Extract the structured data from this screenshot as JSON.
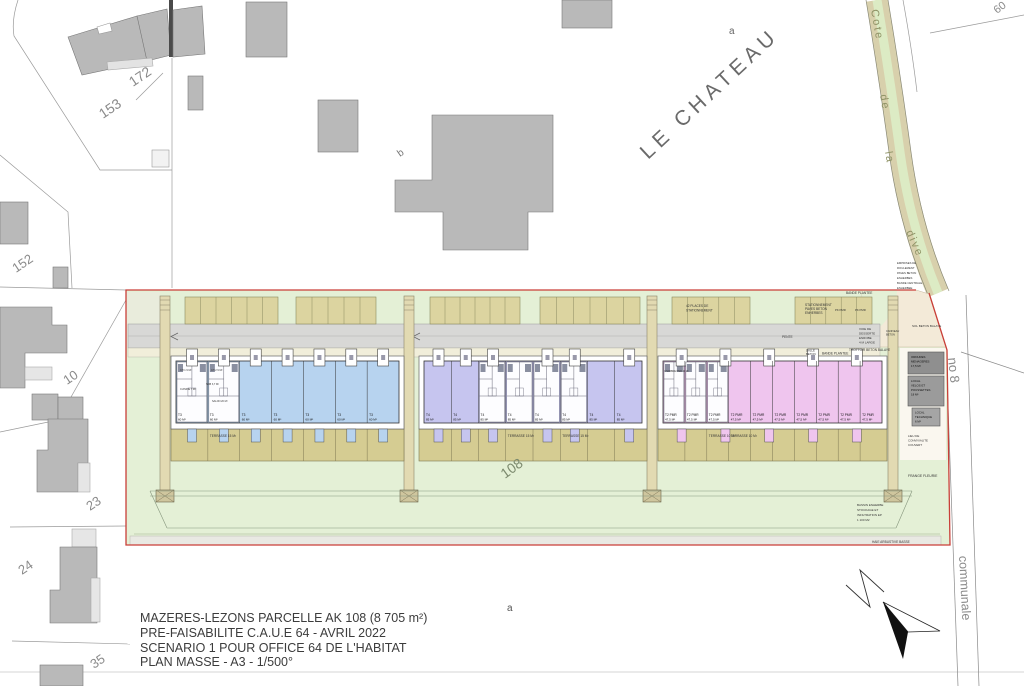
{
  "title_block": {
    "lines": [
      "MAZERES-LEZONS PARCELLE AK 108 (8 705 m²)",
      "PRE-FAISABILITE C.A.U.E 64 - AVRIL 2022",
      "SCENARIO 1 POUR OFFICE 64 DE L'HABITAT",
      "PLAN MASSE - A3 - 1/500°"
    ]
  },
  "parcel_labels": {
    "p153": "153",
    "p172": "172",
    "p152": "152",
    "p10": "10",
    "p23": "23",
    "p24": "24",
    "p35": "35",
    "p60": "60",
    "p108": "108",
    "sub_a_top": "a",
    "sub_a_bottom": "a",
    "sub_b": "b"
  },
  "streets": {
    "le_chateau": "LE  CHATEAU",
    "cote": "Cote",
    "de": "de",
    "la": "la",
    "dive": "dive",
    "no8": "no 8",
    "communale": "communale"
  },
  "annotations": {
    "bande_plantee_top": "BANDE PLANTEE",
    "bande_plantee_mid": "BANDE PLANTEE",
    "places_stationnement": [
      "42 PLACES DE",
      "STATIONNEMENT"
    ],
    "stationnement_paves": [
      "STATIONNEMENT",
      "PAVES BETON",
      "ENHERBES"
    ],
    "pk_pmr": "PK PMR",
    "voie_desserte": [
      "VOIE DE",
      "DESSERTE",
      "ENROBE",
      "4 M LARGE"
    ],
    "pente": "PENTE",
    "trottoir": "TROTTOIR BETON BALAYE",
    "dalle_beton": [
      "DALLE",
      "BETON"
    ],
    "emprises": [
      "EMPRISES DE",
      "ROULEMENT",
      "PAVES BETON",
      "ENHERBES",
      "BANDE CENTRALE",
      "ENHERBEE"
    ],
    "sol_beton": "SOL BETON BALAYE",
    "caniveau": [
      "CANIVEAU",
      "BETON"
    ],
    "frange_fleurie": "FRANGE FLEURIE",
    "bassin": [
      "BASSIN ENHERBE",
      "STOCKAGE ET",
      "INFILTRATION EP",
      "1 100 M2"
    ],
    "haie": "HAIE ARBUSTIVE BASSE"
  },
  "facilities": {
    "ordures": [
      "ORDURES",
      "MENAGERES",
      "17,5 M²"
    ],
    "velos": [
      "LOCAL",
      "VELOS ET",
      "POUSSETTES",
      "18 M²"
    ],
    "technique": [
      "LOCAL",
      "TECHNIQUE",
      "6 M²"
    ],
    "convivialite": [
      "LIEU DE",
      "CONVIVIALITE",
      "COUVERT"
    ]
  },
  "blocks": [
    {
      "type": "T3",
      "units": 7,
      "unit_label": "T3",
      "unit_area": "60 M²",
      "terrace_label": "TERRASSE 15 M²",
      "color": "#b7d3ef"
    },
    {
      "type": "T4",
      "units": 8,
      "unit_label": "T4",
      "unit_area": "85 M²",
      "terrace_label": "TERRASSE 15 M²",
      "color": "#c6c5ef"
    },
    {
      "type": "T2 PMR",
      "units": 10,
      "unit_label": "T2 PMR",
      "unit_area": "47,5 M²",
      "terrace_label": "TERRASSE 10 M²",
      "color": "#efc5ee"
    }
  ],
  "rooms": {
    "ch1": "CH 1 9 M²",
    "ch2": "CH 2 9 M²",
    "cuisine": "CUISINE 7 M²",
    "salon": "SALON 20 M²",
    "sdb": "SDB 3,7 M²",
    "chambre_pmr": "CHAMBRE PMR 11 M²"
  },
  "colors": {
    "site_green": "#e4f0d6",
    "boundary_red": "#c93f38",
    "parking_tan": "#dcd4a0",
    "terrace_khaki": "#d5cc92",
    "road_gray": "#d8d8d6",
    "sidewalk": "#f1eeda",
    "building_gray": "#b9b9b9",
    "road_tan": "#d8d0ac",
    "road_center_green": "#dcebc4",
    "entry_beige": "#f3ead8"
  }
}
